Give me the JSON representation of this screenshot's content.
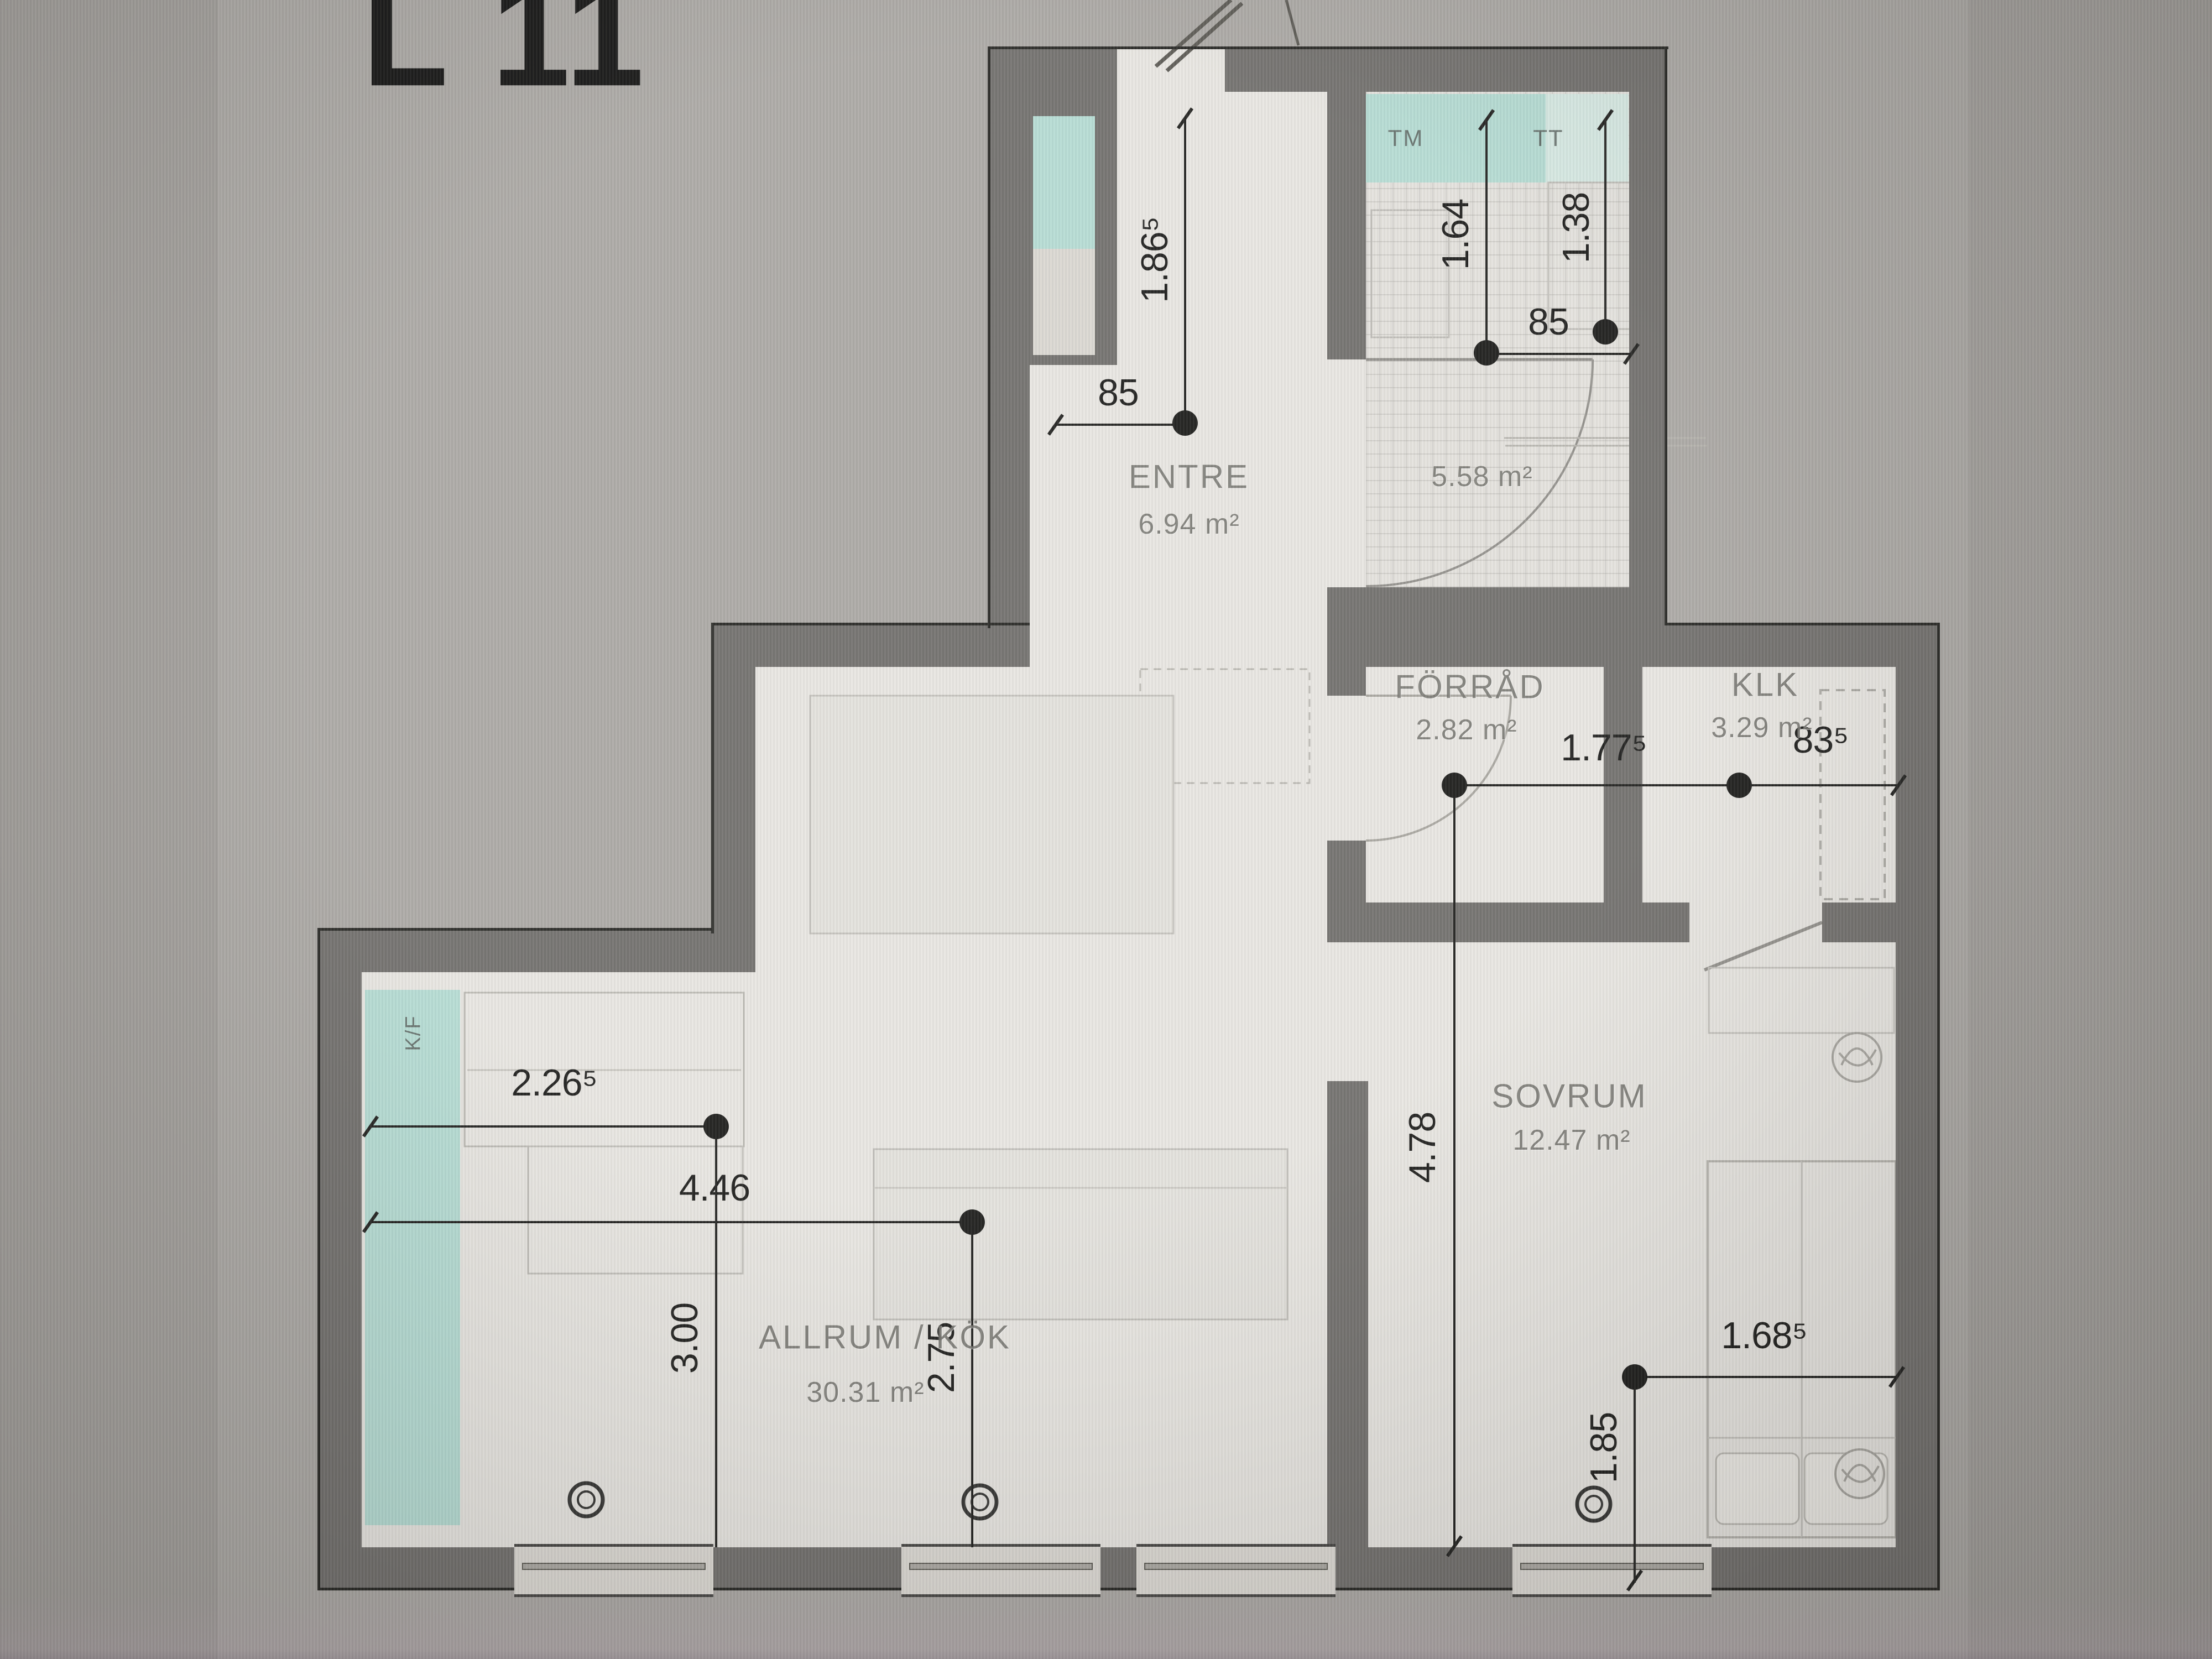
{
  "title": "L 11",
  "rooms": [
    {
      "name": "ENTRE",
      "area": "6.94 m²"
    },
    {
      "name": "",
      "area": "5.58 m²"
    },
    {
      "name": "FÖRRÅD",
      "area": "2.82 m²"
    },
    {
      "name": "KLK",
      "area": "3.29 m²"
    },
    {
      "name": "SOVRUM",
      "area": "12.47 m²"
    },
    {
      "name": "ALLRUM / KÖK",
      "area": "30.31 m²"
    }
  ],
  "fixtures": {
    "washing_machine": "TM",
    "dryer": "TT",
    "fridge_freezer": "K/F"
  },
  "dimensions": {
    "entre_depth": "1.86⁵",
    "entre_opening": "85",
    "bath_left": "1.64",
    "bath_right": "1.38",
    "bath_opening": "85",
    "forrad_width": "1.77⁵",
    "klk_width": "83⁵",
    "lower_depth": "4.78",
    "kitchen_run": "2.26⁵",
    "allrum_width": "4.46",
    "allrum_left_depth": "3.00",
    "allrum_mid_depth": "2.75",
    "sovrum_width": "1.68⁵",
    "sovrum_depth": "1.85"
  },
  "colors": {
    "background": "#a9a6a2",
    "floor": "#e7e5e0",
    "wall": "#6e6c69",
    "accent_teal": "#b3dbd2",
    "dimension_ink": "#1b1b19",
    "room_label": "#807e79"
  }
}
